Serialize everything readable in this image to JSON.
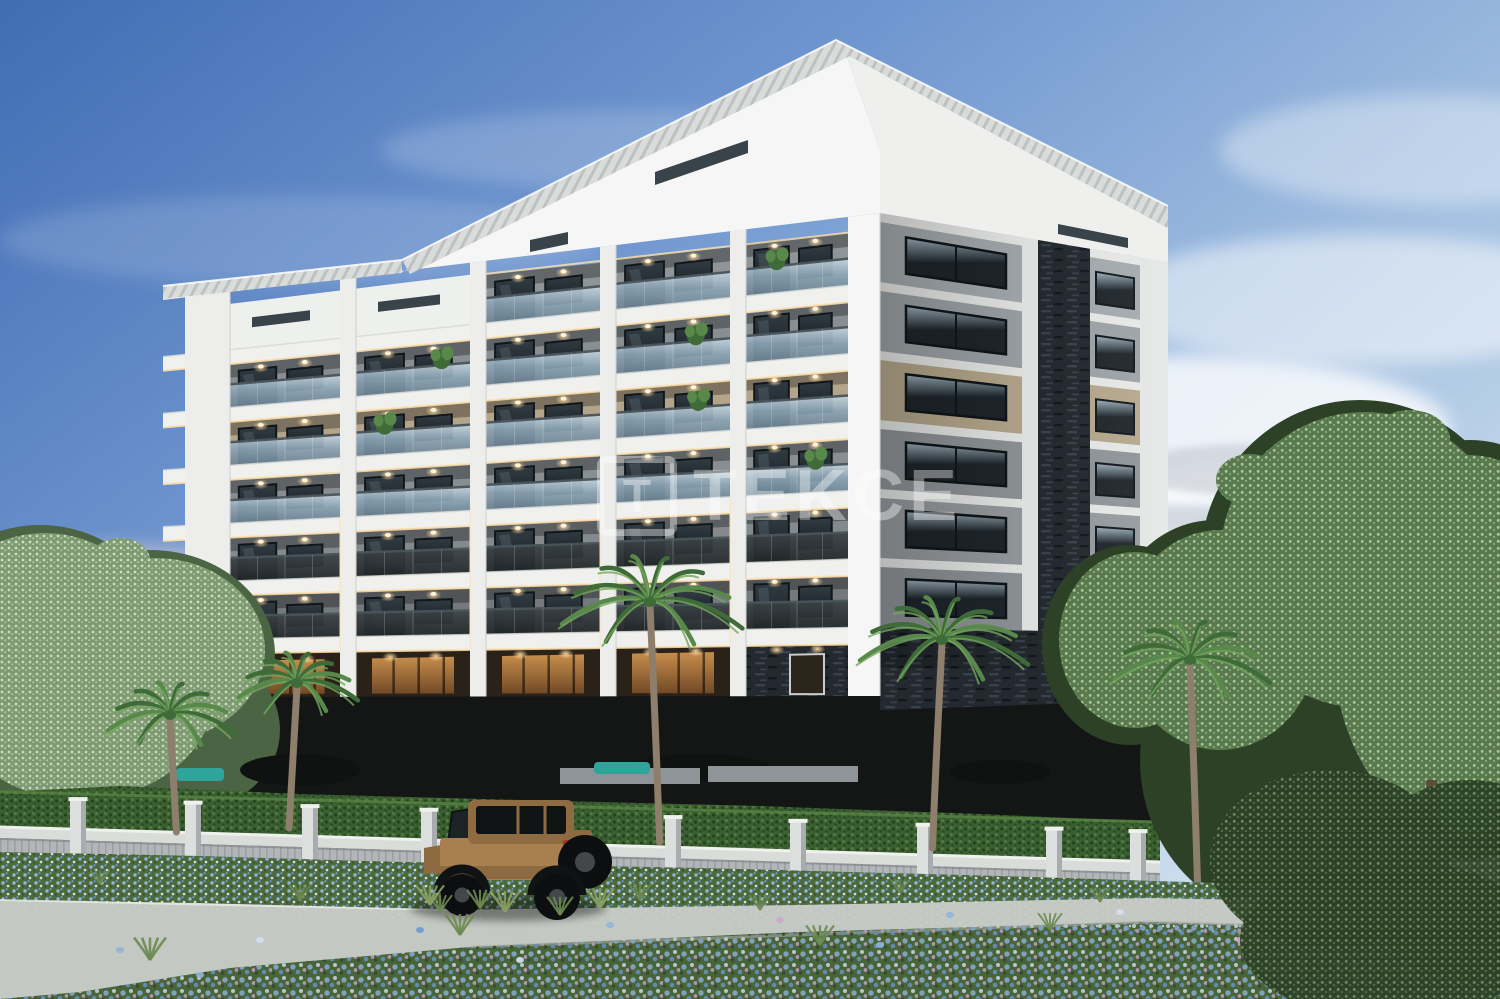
{
  "meta": {
    "kind": "architectural-3d-render",
    "description": "Dusk rendering of a modern seven-storey apartment block with recessed glass balconies, a dark slate corner column, palm trees, a gray slatted fence, a blue flower meadow and a tan 4x4 parked outside",
    "time_of_day": "dusk"
  },
  "watermark": {
    "logo_letter": "T",
    "text": "TEKCE",
    "color": "#ffffff",
    "opacity": 0.38
  },
  "building": {
    "floors": 7,
    "front_balcony_bays": 5,
    "attic_slit_bays": 2,
    "side_window_columns": 2,
    "roof_slit_windows": 3,
    "corner_stone_column": true,
    "balcony_plants": 6,
    "lit_soffit_lights_per_bay": 2
  },
  "scene": {
    "palm_trees": 5,
    "fence_pillars": 10,
    "vehicle": {
      "type": "4x4 SUV",
      "color_name": "tan"
    },
    "flower_colors": [
      "blue",
      "lavender",
      "white",
      "pink"
    ]
  },
  "palette": {
    "skyTop": "#416cb4",
    "skyMid": "#6f96cf",
    "skyLight": "#a6c2e2",
    "skyPale": "#dde9f3",
    "cloudWhite": "#ffffff",
    "cloudGray": "#b7bcc8",
    "hazePink": "#ecd9d4",
    "roofWhite": "#f5f6f5",
    "roofRight": "#eff0ee",
    "ribLight": "#d9dcda",
    "ribDark": "#bdc1bf",
    "slab": "#f0f1ef",
    "slabEdge": "#d7dad6",
    "pier": "#edeeec",
    "pierShade": "#cfd2cf",
    "atticWall": "#eef0ee",
    "wallGray1": "#8f9498",
    "wallGray2": "#898e92",
    "wallGray3": "#84898d",
    "wallTan": "#b4a489",
    "wallDark": "#74797d",
    "glassTop": "#c6d5de",
    "glassMid": "#8ba4b5",
    "glassBot": "#6b8294",
    "glassDark1": "#3c4347",
    "glassDark2": "#222729",
    "railLine": "#49545b",
    "winTop": "#313c43",
    "winBot": "#161c20",
    "winReflect": "#93a9b6",
    "frame": "#10161a",
    "sideWinTop": "#a3b6c2",
    "sideWinBot": "#1e262c",
    "stone": "#23292f",
    "stoneFleck1": "#39424b",
    "stoneFleck2": "#12171c",
    "sideLit": "#a6acb0",
    "sideG1": "#9ea4a8",
    "sideG2": "#989da1",
    "sideTan": "#b7a98d",
    "sideG3": "#91969a",
    "sideWhite": "#e9ebe9",
    "sideTrim": "#e6e8e7",
    "ledWarm": "#ffe2ae",
    "lightDot": "#ffd9a0",
    "podium": "#141615",
    "hedge": "#3a5f31",
    "hedgeHi": "#598344",
    "hedgeDark": "#27421f",
    "fenceRailTop": "#eff1ee",
    "fenceRail": "#d9dcd8",
    "fencePanel": "#b2b6b8",
    "fenceSlat": "#9ca0a3",
    "pillarFace": "#dcdfdd",
    "pillarSide": "#a8acae",
    "treeSageD": "#4b6544",
    "treeSageM": "#7e9a72",
    "treeSageHi": "#d0dfc3",
    "treeGreenD": "#2c4126",
    "treeGreenM": "#597a4e",
    "treeGreenHi": "#aac496",
    "trunkBrown": "#5c4c3a",
    "palmDark": "#3f6b39",
    "palmMid": "#58894a",
    "palmLight": "#74a55e",
    "palmTrunk": "#8d7f6b",
    "grassBase": "#4d6a3b",
    "grassDark": "#354f2b",
    "grassLight": "#6d8a52",
    "flowerBlue": "#8fb4dc",
    "flowerBlue2": "#6d99cd",
    "flowerPale": "#d3e1ef",
    "flowerPink": "#cda6cc",
    "pathLight": "#c9ccc8",
    "pathShade": "#b0b3af",
    "jeepBody": "#a87f4f",
    "jeepBodyD": "#8d6a41",
    "jeepTop": "#8f6b42",
    "jeepBlack": "#101314",
    "jeepTire": "#0c0e0f",
    "jeepHub": "#43474a",
    "jeepRed": "#a8352b",
    "teal": "#2ea49a",
    "planter": "#8e9497",
    "furnDark": "#101211",
    "warmGlow1": "#d89a52",
    "warmGlow2": "#7a4e27"
  }
}
